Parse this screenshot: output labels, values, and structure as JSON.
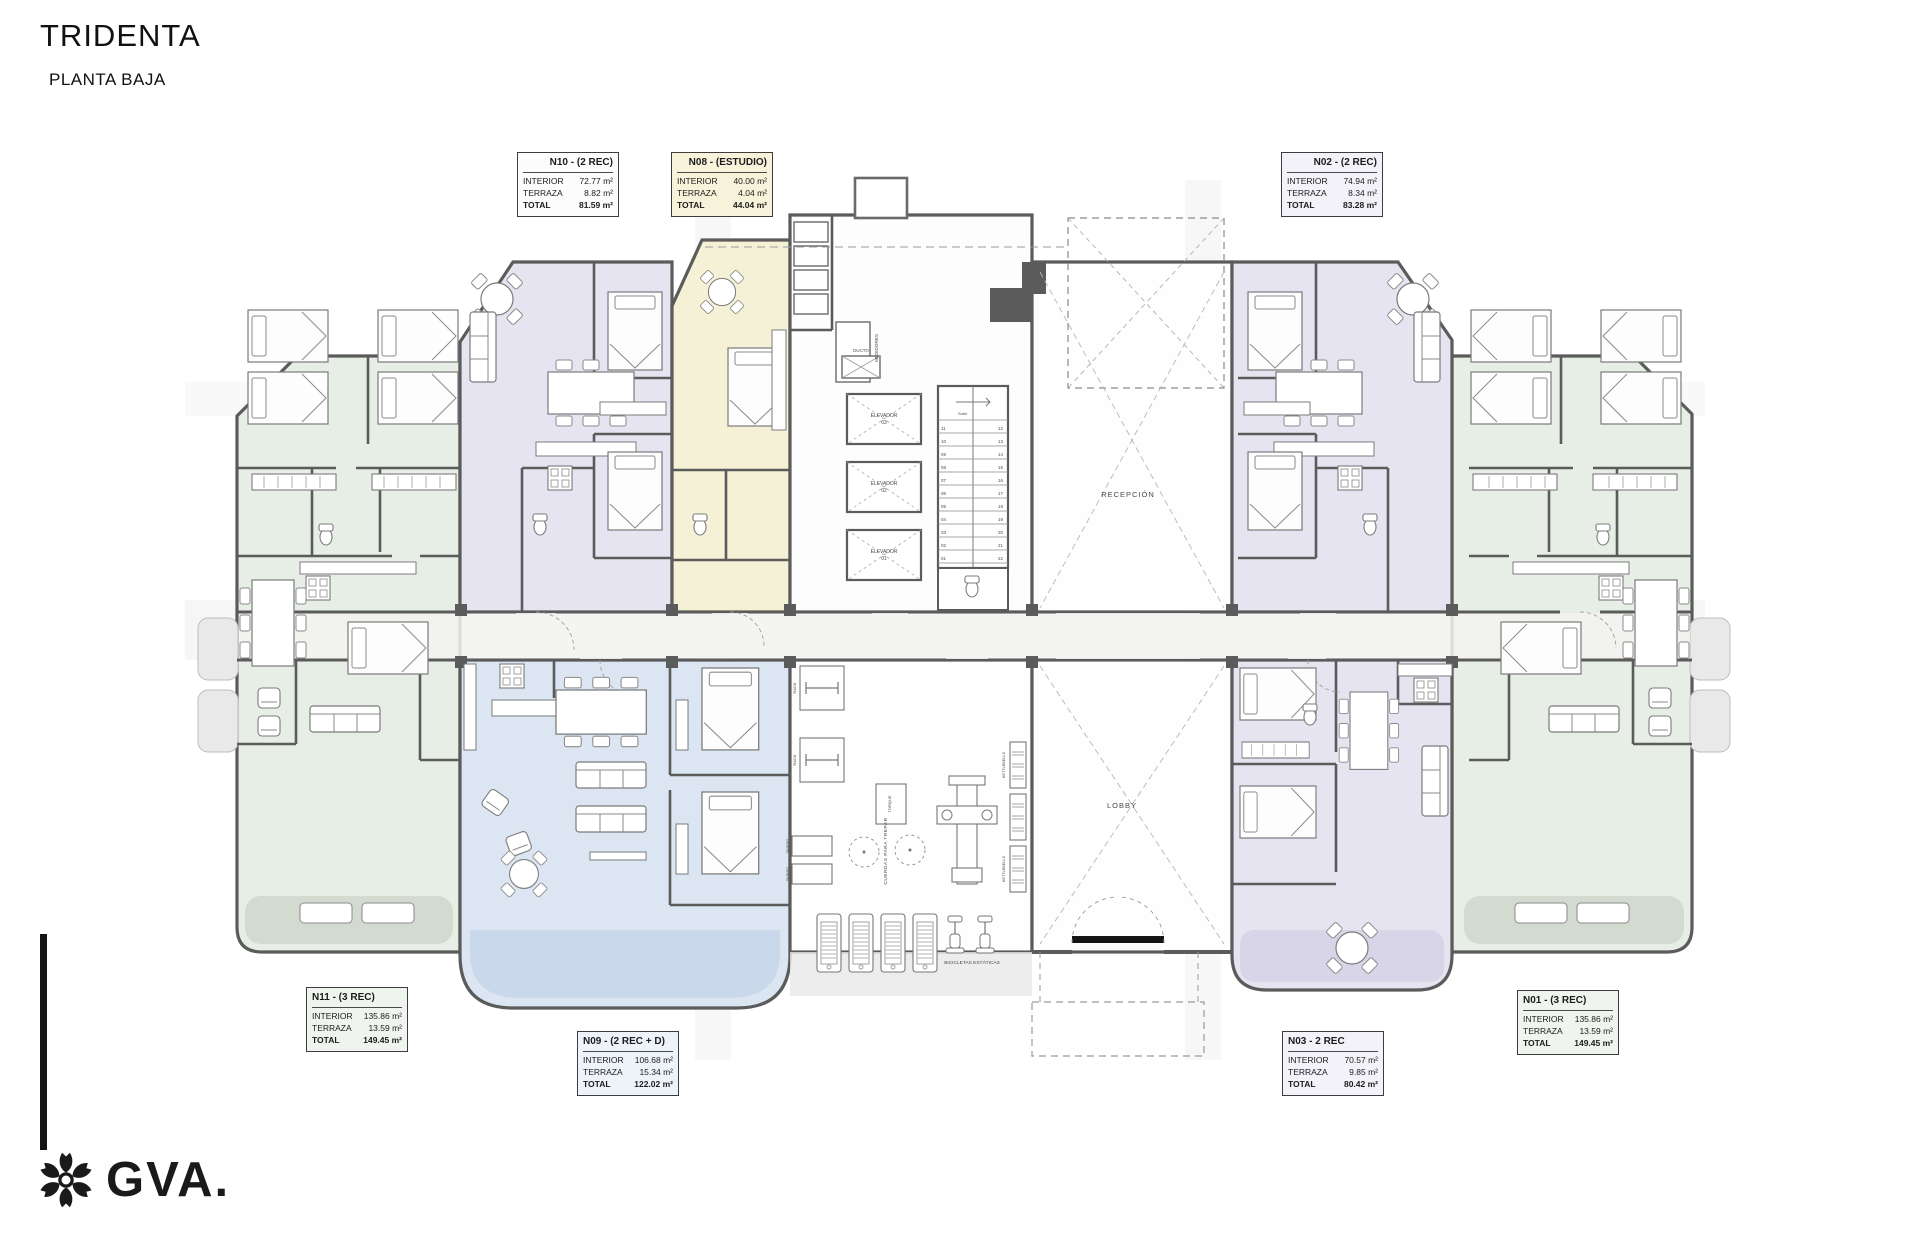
{
  "header": {
    "title": "TRIDENTA",
    "subtitle": "PLANTA BAJA"
  },
  "logo": {
    "brand": "GVA."
  },
  "unit_row_labels": {
    "interior": "INTERIOR",
    "terraza": "TERRAZA",
    "total": "TOTAL"
  },
  "units": {
    "n10": {
      "title": "N10 - (2 REC)",
      "interior": "72.77 m²",
      "terraza": "8.82 m²",
      "total": "81.59 m²"
    },
    "n08": {
      "title": "N08 - (ESTUDIO)",
      "interior": "40.00 m²",
      "terraza": "4.04 m²",
      "total": "44.04 m²"
    },
    "n02": {
      "title": "N02 - (2 REC)",
      "interior": "74.94 m²",
      "terraza": "8.34 m²",
      "total": "83.28 m²"
    },
    "n11": {
      "title": "N11 - (3 REC)",
      "interior": "135.86 m²",
      "terraza": "13.59 m²",
      "total": "149.45 m²"
    },
    "n09": {
      "title": "N09 - (2 REC + D)",
      "interior": "106.68 m²",
      "terraza": "15.34 m²",
      "total": "122.02 m²"
    },
    "n03": {
      "title": "N03 - 2 REC",
      "interior": "70.57 m²",
      "terraza": "9.85 m²",
      "total": "80.42 m²"
    },
    "n01": {
      "title": "N01 - (3 REC)",
      "interior": "135.86 m²",
      "terraza": "13.59 m²",
      "total": "149.45 m²"
    }
  },
  "plan": {
    "reception": "RECEPCIÓN",
    "lobby": "LOBBY",
    "elevator_word": "ELEVADOR",
    "elevator_numbers": [
      "01",
      "02",
      "03"
    ],
    "medidores": "MEDIDORES",
    "ducto": "DUCTO",
    "stairs_note": "Sube",
    "gym": {
      "cuerdas": "CUERDAS PARA TREPAR",
      "bicicletas": "BICICLETAS ESTÁTICAS",
      "kettlebells": "KETTLEBELLS",
      "rack": "RACK",
      "skierg": "SKIERG",
      "torque": "TORQUE"
    },
    "stairs_left": [
      "11",
      "10",
      "09",
      "08",
      "07",
      "06",
      "05",
      "04",
      "03",
      "02",
      "01"
    ],
    "stairs_right": [
      "12",
      "13",
      "14",
      "15",
      "16",
      "17",
      "18",
      "19",
      "20",
      "21",
      "22"
    ]
  },
  "colors": {
    "unit_green": "#e7eee5",
    "unit_lavender": "#e6e4f1",
    "unit_yellow": "#f4f1d6",
    "unit_blue": "#dbe6f2",
    "wall_gray": "#5b5b5b",
    "terrace_gray": "#e3e3e3"
  }
}
